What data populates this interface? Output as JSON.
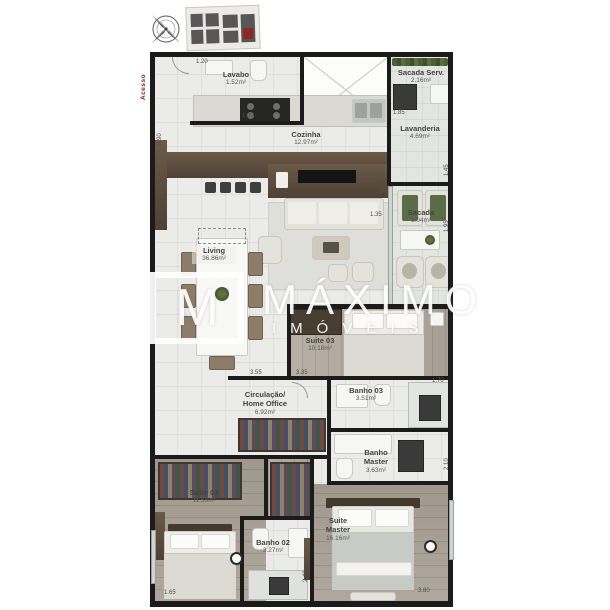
{
  "header": {
    "compass": "compass-rose",
    "keyplan_highlight": "#8e2626"
  },
  "plan": {
    "access_label": "Acesso",
    "watermark": {
      "logo_letter": "M",
      "title": "MÁXIMO",
      "subtitle": "IMÓVEIS"
    },
    "rooms": [
      {
        "name": "Lavabo",
        "area": "1.52m²"
      },
      {
        "name": "Sacada Serv.",
        "area": "2.16m²"
      },
      {
        "name": "Cozinha",
        "area": "12.97m²"
      },
      {
        "name": "Lavanderia",
        "area": "4.69m²"
      },
      {
        "name": "Sacada",
        "area": "6.04m²"
      },
      {
        "name": "Living",
        "area": "36.86m²"
      },
      {
        "name": "Suite 03",
        "area": "10.18m²"
      },
      {
        "name": "Circulação/ Home Office",
        "area": "6.92m²"
      },
      {
        "name": "Banho 03",
        "area": "3.51m²"
      },
      {
        "name": "Banho Master",
        "area": "3.63m²"
      },
      {
        "name": "Suite 02",
        "area": "11.53m²"
      },
      {
        "name": "Banho 02",
        "area": "3.27m²"
      },
      {
        "name": "Suite Master",
        "area": "16.16m²"
      }
    ],
    "dimensions": [
      "1.20",
      "1.30",
      "1.85",
      "1.45",
      "6.95",
      "9.90",
      "1.35",
      "1.95",
      "3.55",
      "3.35",
      "1.70",
      "2.10",
      "2.40",
      "3.80",
      "1.65"
    ]
  }
}
